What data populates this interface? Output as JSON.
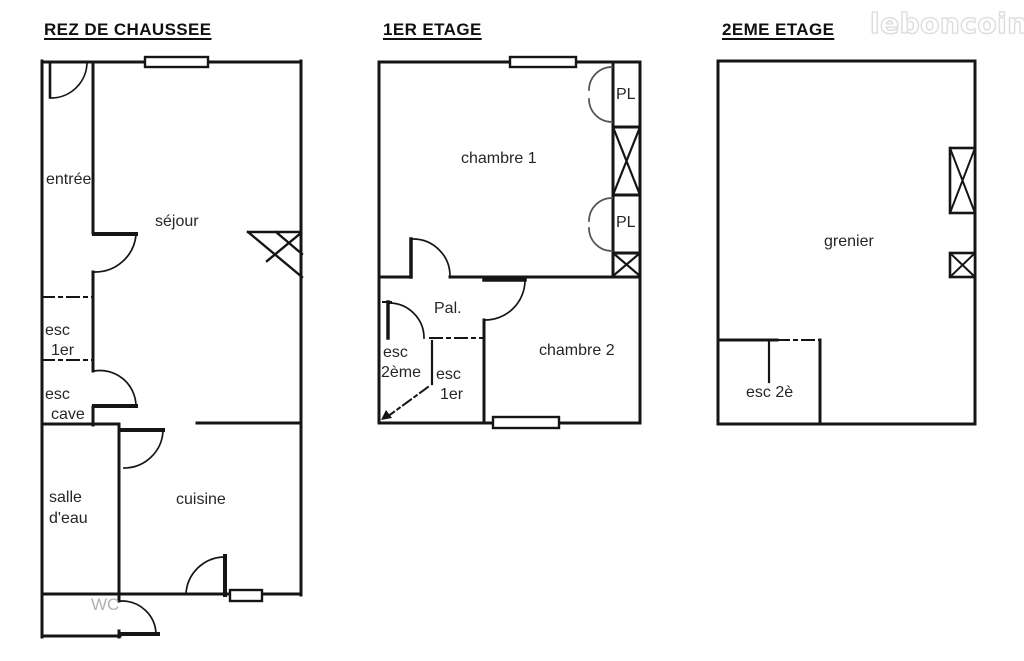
{
  "watermark": {
    "brand": "leboncoin"
  },
  "floors": [
    {
      "title": "REZ DE CHAUSSEE",
      "labels": {
        "entree": "entrée",
        "sejour": "séjour",
        "esc1er_l1": "esc",
        "esc1er_l2": "1er",
        "esccave_l1": "esc",
        "esccave_l2": "cave",
        "salledeau_l1": "salle",
        "salledeau_l2": "d'eau",
        "cuisine": "cuisine",
        "wc": "WC"
      }
    },
    {
      "title": "1ER ETAGE",
      "labels": {
        "chambre1": "chambre 1",
        "pl_haut": "PL",
        "pl_bas": "PL",
        "palier": "Pal.",
        "esc2eme_l1": "esc",
        "esc2eme_l2": "2ème",
        "esc1er_l1": "esc",
        "esc1er_l2": "1er",
        "chambre2": "chambre 2"
      }
    },
    {
      "title": "2EME ETAGE",
      "labels": {
        "grenier": "grenier",
        "esc2e": "esc 2è"
      }
    }
  ]
}
